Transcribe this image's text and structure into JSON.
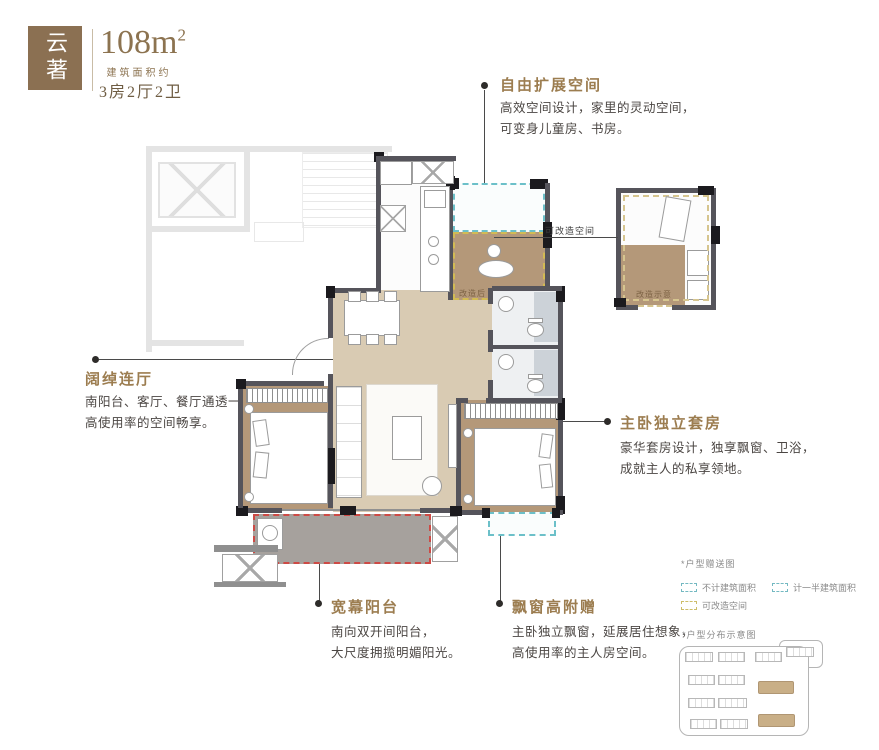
{
  "header": {
    "logo_text": "云著",
    "area_value": "108m",
    "area_sup": "2",
    "area_caption": "建筑面积约",
    "spec": "3房2厅2卫"
  },
  "annotations": {
    "expand": {
      "title": "自由扩展空间",
      "lines": [
        "高效空间设计，家里的灵动空间，",
        "可变身儿童房、书房。"
      ]
    },
    "hall": {
      "title": "阔绰连厅",
      "lines": [
        "南阳台、客厅、餐厅通透一体，",
        "高使用率的空间畅享。"
      ]
    },
    "suite": {
      "title": "主卧独立套房",
      "lines": [
        "豪华套房设计，独享飘窗、卫浴，",
        "成就主人的私享领地。"
      ]
    },
    "balcony": {
      "title": "宽幕阳台",
      "lines": [
        "南向双开间阳台，",
        "大尺度拥揽明媚阳光。"
      ]
    },
    "baywindow": {
      "title": "飘窗高附赠",
      "lines": [
        "主卧独立飘窗，延展居住想象，",
        "高使用率的主人房空间。"
      ]
    }
  },
  "plan_labels": {
    "convertible": "可改造空间",
    "after_tag": "改造后",
    "sketch_tag": "改造示意"
  },
  "legend": {
    "title": "*户型赠送图",
    "items": [
      {
        "label": "不计建筑面积",
        "style": "teal"
      },
      {
        "label": "计一半建筑面积",
        "style": "teal"
      },
      {
        "label": "可改造空间",
        "style": "yellow"
      }
    ],
    "sitemap_title": "*户型分布示意图"
  },
  "colors": {
    "gold": "#9c7d50",
    "logo_brown": "#8b7052",
    "wall_grey": "#55545b",
    "wall_black": "#1b1a1e",
    "floor_tan": "#b49879",
    "floor_beige": "#d9cbb3",
    "balcony_grey": "#a6a19d",
    "teal_dash": "#6cc0c9",
    "yellow_dash": "#d2bb54",
    "red_dash": "#cd4a45",
    "highlight_tan": "#c9af87"
  }
}
